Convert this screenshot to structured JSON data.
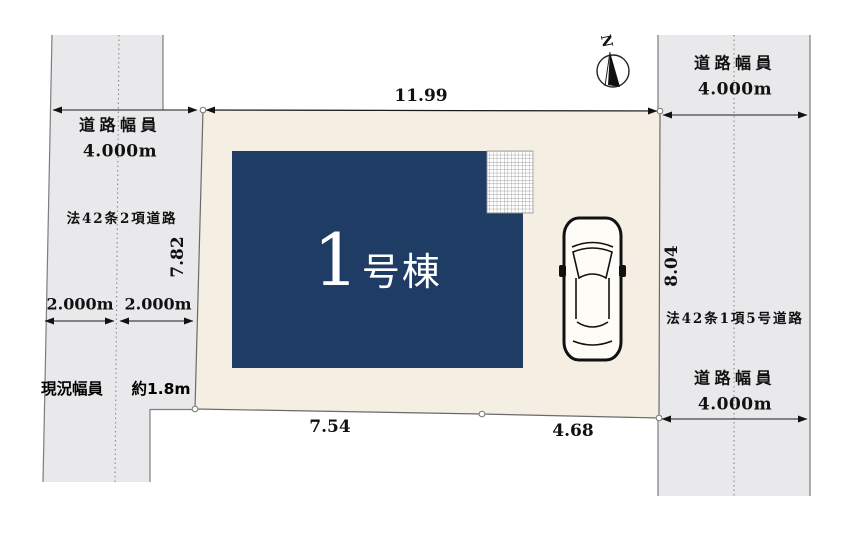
{
  "plan": {
    "north_label": "N",
    "lot": {
      "dim_top": "11.99",
      "dim_left": "7.82",
      "dim_right": "8.04",
      "dim_bottom_left": "7.54",
      "dim_bottom_right": "4.68"
    },
    "building": {
      "number": "1",
      "suffix": "号棟"
    },
    "road_left": {
      "width_title": "道路幅員",
      "width_value": "4.000m",
      "law": "法42条2項道路",
      "setback_left": "2.000m",
      "setback_right": "2.000m",
      "current_label": "現況幅員",
      "current_value": "約1.8m"
    },
    "road_right": {
      "width_title_top": "道路幅員",
      "width_value_top": "4.000m",
      "law": "法42条1項5号道路",
      "width_title_bottom": "道路幅員",
      "width_value_bottom": "4.000m"
    },
    "colors": {
      "lot_fill": "#f4efe2",
      "lot_stroke": "#6a6a6a",
      "building_fill": "#1e3c64",
      "road_fill": "#e9e9eb",
      "road_stroke": "#7d7d7d",
      "dimension_line": "#1a1a1a",
      "centerline": "#8a8a8a",
      "building_text": "#ffffff"
    }
  }
}
